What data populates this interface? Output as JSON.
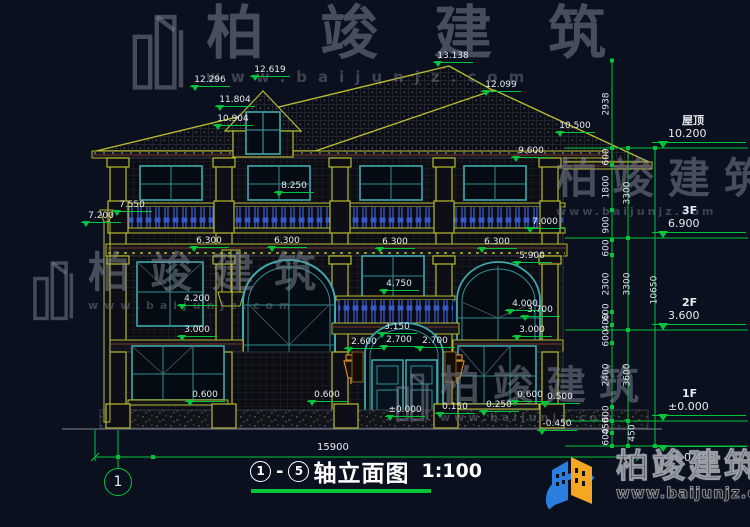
{
  "watermarks": [
    {
      "text": "柏竣建筑",
      "url": "www.baijunjz.com"
    },
    {
      "text": "柏竣建筑",
      "url": "www.baijunjz.com"
    },
    {
      "text": "柏竣建筑",
      "url": "www.baijunjz.com"
    },
    {
      "text": "柏竣建筑",
      "url": "www.baijunjz.com"
    }
  ],
  "brand": {
    "text": "柏竣建筑",
    "url": "www.baijunjz.com"
  },
  "title_block": {
    "axis_from": "1",
    "dash": "-",
    "axis_to": "5",
    "name": "轴立面图",
    "scale": "1:100"
  },
  "axis_bubble": {
    "label": "1"
  },
  "drawing": {
    "bottom_dim": {
      "text": "15900",
      "x": 333,
      "y": 442
    },
    "elevation_labels": [
      {
        "t": "13.138",
        "x": 455,
        "y": 52
      },
      {
        "t": "12.619",
        "x": 272,
        "y": 66
      },
      {
        "t": "12.296",
        "x": 212,
        "y": 76
      },
      {
        "t": "12.099",
        "x": 503,
        "y": 81
      },
      {
        "t": "11.804",
        "x": 237,
        "y": 96
      },
      {
        "t": "10.904",
        "x": 235,
        "y": 115
      },
      {
        "t": "10.500",
        "x": 577,
        "y": 122
      },
      {
        "t": "9.600",
        "x": 533,
        "y": 147
      },
      {
        "t": "8.250",
        "x": 296,
        "y": 182
      },
      {
        "t": "7.550",
        "x": 134,
        "y": 201
      },
      {
        "t": "7.200",
        "x": 103,
        "y": 212
      },
      {
        "t": "7.000",
        "x": 547,
        "y": 218
      },
      {
        "t": "6.300",
        "x": 211,
        "y": 237
      },
      {
        "t": "6.300",
        "x": 289,
        "y": 237
      },
      {
        "t": "6.300",
        "x": 397,
        "y": 238
      },
      {
        "t": "6.300",
        "x": 499,
        "y": 238
      },
      {
        "t": "5.900",
        "x": 534,
        "y": 252
      },
      {
        "t": "4.750",
        "x": 401,
        "y": 280
      },
      {
        "t": "4.200",
        "x": 199,
        "y": 295
      },
      {
        "t": "4.000",
        "x": 527,
        "y": 300
      },
      {
        "t": "3.700",
        "x": 542,
        "y": 306
      },
      {
        "t": "3.150",
        "x": 399,
        "y": 323
      },
      {
        "t": "3.000",
        "x": 199,
        "y": 326
      },
      {
        "t": "3.000",
        "x": 534,
        "y": 326
      },
      {
        "t": "2.700",
        "x": 401,
        "y": 336
      },
      {
        "t": "2.600",
        "x": 366,
        "y": 338
      },
      {
        "t": "2.700",
        "x": 437,
        "y": 337
      },
      {
        "t": "0.600",
        "x": 207,
        "y": 391
      },
      {
        "t": "0.600",
        "x": 329,
        "y": 391
      },
      {
        "t": "0.600",
        "x": 532,
        "y": 391
      },
      {
        "t": "0.500",
        "x": 562,
        "y": 393
      },
      {
        "t": "0.250",
        "x": 501,
        "y": 401
      },
      {
        "t": "0.150",
        "x": 457,
        "y": 403
      },
      {
        "t": "±0.000",
        "x": 407,
        "y": 406
      },
      {
        "t": "-0.450",
        "x": 559,
        "y": 420
      }
    ],
    "level_markers": [
      {
        "name": "屋顶",
        "value": "10.200",
        "line_y": 148,
        "below": false
      },
      {
        "name": "3F",
        "value": "6.900",
        "line_y": 238,
        "below": false
      },
      {
        "name": "2F",
        "value": "3.600",
        "line_y": 330,
        "below": false
      },
      {
        "name": "1F",
        "value": "±0.000",
        "line_y": 421,
        "below": false
      },
      {
        "name": "",
        "value": "-0.450",
        "line_y": 446,
        "below": true
      }
    ],
    "chain_dims": [
      {
        "t": "2938",
        "x": 607,
        "y": 104
      },
      {
        "t": "600",
        "x": 607,
        "y": 157
      },
      {
        "t": "1800",
        "x": 607,
        "y": 187
      },
      {
        "t": "900",
        "x": 607,
        "y": 225
      },
      {
        "t": "600",
        "x": 607,
        "y": 248
      },
      {
        "t": "2300",
        "x": 607,
        "y": 284
      },
      {
        "t": "600",
        "x": 607,
        "y": 312
      },
      {
        "t": "400",
        "x": 607,
        "y": 322
      },
      {
        "t": "600",
        "x": 607,
        "y": 338
      },
      {
        "t": "2400",
        "x": 607,
        "y": 375
      },
      {
        "t": "600",
        "x": 607,
        "y": 414
      },
      {
        "t": "450",
        "x": 607,
        "y": 426
      },
      {
        "t": "600",
        "x": 607,
        "y": 437
      },
      {
        "t": "3300",
        "x": 628,
        "y": 193
      },
      {
        "t": "3300",
        "x": 628,
        "y": 284
      },
      {
        "t": "3600",
        "x": 628,
        "y": 375
      },
      {
        "t": "450",
        "x": 633,
        "y": 433
      },
      {
        "t": "10650",
        "x": 655,
        "y": 290
      }
    ]
  }
}
